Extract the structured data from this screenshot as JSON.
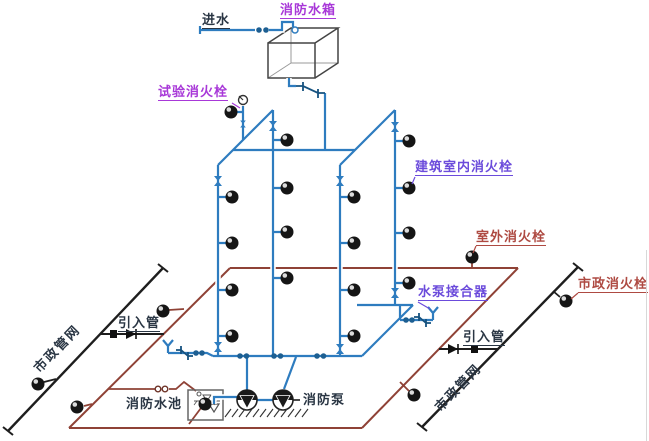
{
  "diagram": {
    "title_hint": "fire-protection water supply system schematic",
    "labels": {
      "water_inlet": "进水",
      "fire_water_tank": "消防水箱",
      "test_fire_hydrant": "试验消火栓",
      "indoor_building_hydrant": "建筑室内消火栓",
      "outdoor_hydrant": "室外消火栓",
      "pump_adapter": "水泵接合器",
      "municipal_hydrant": "市政消火栓",
      "inlet_pipe_left": "引入管",
      "inlet_pipe_right": "引入管",
      "municipal_network_left": "市政管网",
      "municipal_network_right": "市政管网",
      "fire_water_pool": "消防水池",
      "fire_pump": "消防泵"
    },
    "colors": {
      "pipe_blue": "#2E7CBF",
      "pipe_blue_dark": "#16527F",
      "ring_red": "#8F4236",
      "municipal_black": "#1E1E1E",
      "label_purple": "#A838D8",
      "label_violet": "#6B4BDB",
      "label_red": "#AE4A42",
      "label_dark": "#2A3644",
      "hydrant_fill": "#151515"
    },
    "symbols": {
      "fire-hydrant-icon": "filled circle with highlight",
      "gate-valve-icon": "bowtie",
      "check-valve-icon": "offset Z bars",
      "pressure-gauge-icon": "circle with needle",
      "pump-icon": "circle with down triangle",
      "foot-valve-icon": "down triangle in pool",
      "float-valve-icon": "small circle at tank/pool inlet",
      "siamese-connector-icon": "Y fork",
      "water-level-icon": "triangle over hatched line"
    }
  }
}
